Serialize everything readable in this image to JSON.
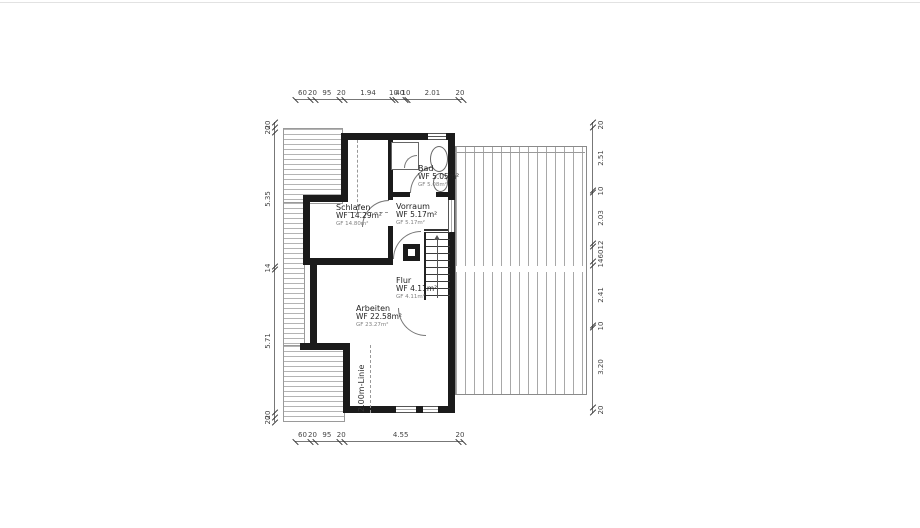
{
  "plan": {
    "rooms": {
      "schlafen": {
        "name": "Schlafen",
        "wf": "WF 14.29m²",
        "gf": "GF 14.80m²"
      },
      "bad": {
        "name": "Bad",
        "wf": "WF 5.05m²",
        "gf": "GF 5.08m²"
      },
      "vorraum": {
        "name": "Vorraum",
        "wf": "WF 5.17m²",
        "gf": "GF 5.17m²"
      },
      "flur": {
        "name": "Flur",
        "wf": "WF 4.11m²",
        "gf": "GF 4.11m²"
      },
      "arbeiten": {
        "name": "Arbeiten",
        "wf": "WF 22.58m²",
        "gf": "GF 23.27m²"
      }
    },
    "annotations": {
      "two_meter_line": "2.00m-Linie"
    },
    "dimensions": {
      "top": [
        "60",
        "20",
        "95",
        "20",
        "1.94",
        "10",
        "40",
        "10",
        "2.01",
        "20"
      ],
      "bottom": [
        "60",
        "20",
        "95",
        "20",
        "4.55",
        "20"
      ],
      "left": [
        "20",
        "20",
        "5.35",
        "14",
        "5.71",
        "20",
        "20"
      ],
      "right": [
        "20",
        "2.51",
        "10",
        "2.03",
        "12",
        "60",
        "14",
        "2.41",
        "10",
        "3.20",
        "20"
      ]
    },
    "colors": {
      "wall": "#1b1b1b",
      "hatch_light": "#b4b4b4",
      "hatch_dark": "#9a9a9a",
      "dimension_text": "#444444"
    }
  }
}
